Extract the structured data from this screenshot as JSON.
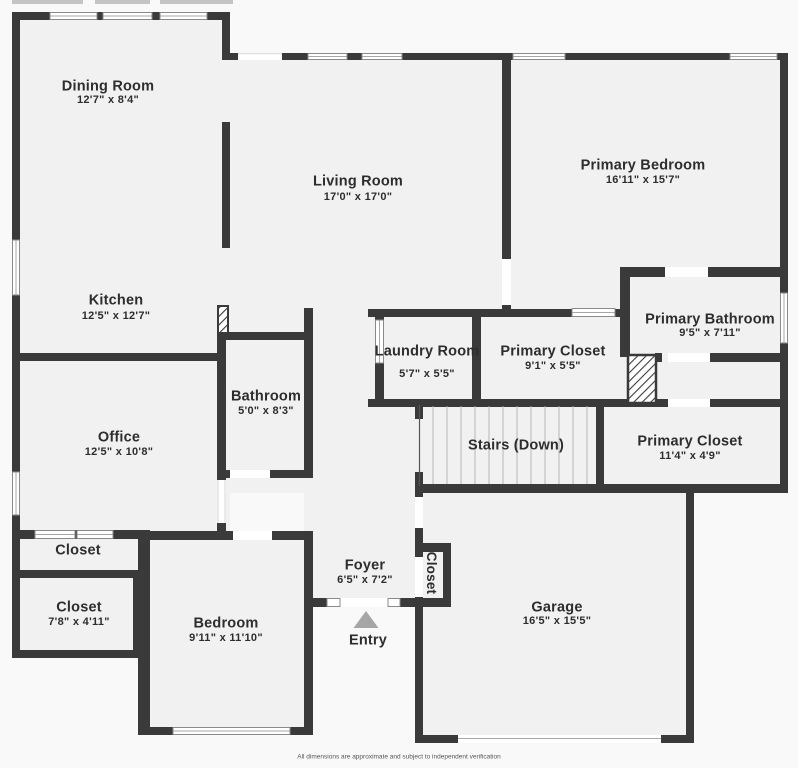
{
  "plan": {
    "disclaimer": "All dimensions are approximate and subject to independent verification",
    "colors": {
      "wall": "#3a3a3a",
      "room_fill": "#f1f1f1",
      "outside": "#f9f9f9",
      "porch_strip": "#c4c4c4",
      "entry_arrow": "#a6a6a6",
      "step_line": "#b8b8b8",
      "text": "#2d2d2d"
    },
    "rooms": {
      "dining": {
        "name": "Dining Room",
        "dims": "12'7\" x 8'4\""
      },
      "living": {
        "name": "Living Room",
        "dims": "17'0\" x 17'0\""
      },
      "primary_bedroom": {
        "name": "Primary Bedroom",
        "dims": "16'11\" x 15'7\""
      },
      "kitchen": {
        "name": "Kitchen",
        "dims": "12'5\" x 12'7\""
      },
      "primary_bathroom": {
        "name": "Primary Bathroom",
        "dims": "9'5\" x 7'11\""
      },
      "laundry": {
        "name": "Laundry Room",
        "dims": "5'7\" x 5'5\""
      },
      "primary_closet_upper": {
        "name": "Primary Closet",
        "dims": "9'1\" x 5'5\""
      },
      "bathroom": {
        "name": "Bathroom",
        "dims": "5'0\" x 8'3\""
      },
      "office": {
        "name": "Office",
        "dims": "12'5\" x 10'8\""
      },
      "stairs": {
        "name": "Stairs (Down)"
      },
      "primary_closet_lower": {
        "name": "Primary Closet",
        "dims": "11'4\" x 4'9\""
      },
      "closet_hall": {
        "name": "Closet"
      },
      "closet_lower": {
        "name": "Closet",
        "dims": "7'8\" x 4'11\""
      },
      "bedroom": {
        "name": "Bedroom",
        "dims": "9'11\" x 11'10\""
      },
      "foyer": {
        "name": "Foyer",
        "dims": "6'5\" x 7'2\""
      },
      "entry": {
        "name": "Entry"
      },
      "garage": {
        "name": "Garage",
        "dims": "16'5\" x 15'5\""
      },
      "closet_foyer": {
        "name": "Closet"
      }
    }
  }
}
